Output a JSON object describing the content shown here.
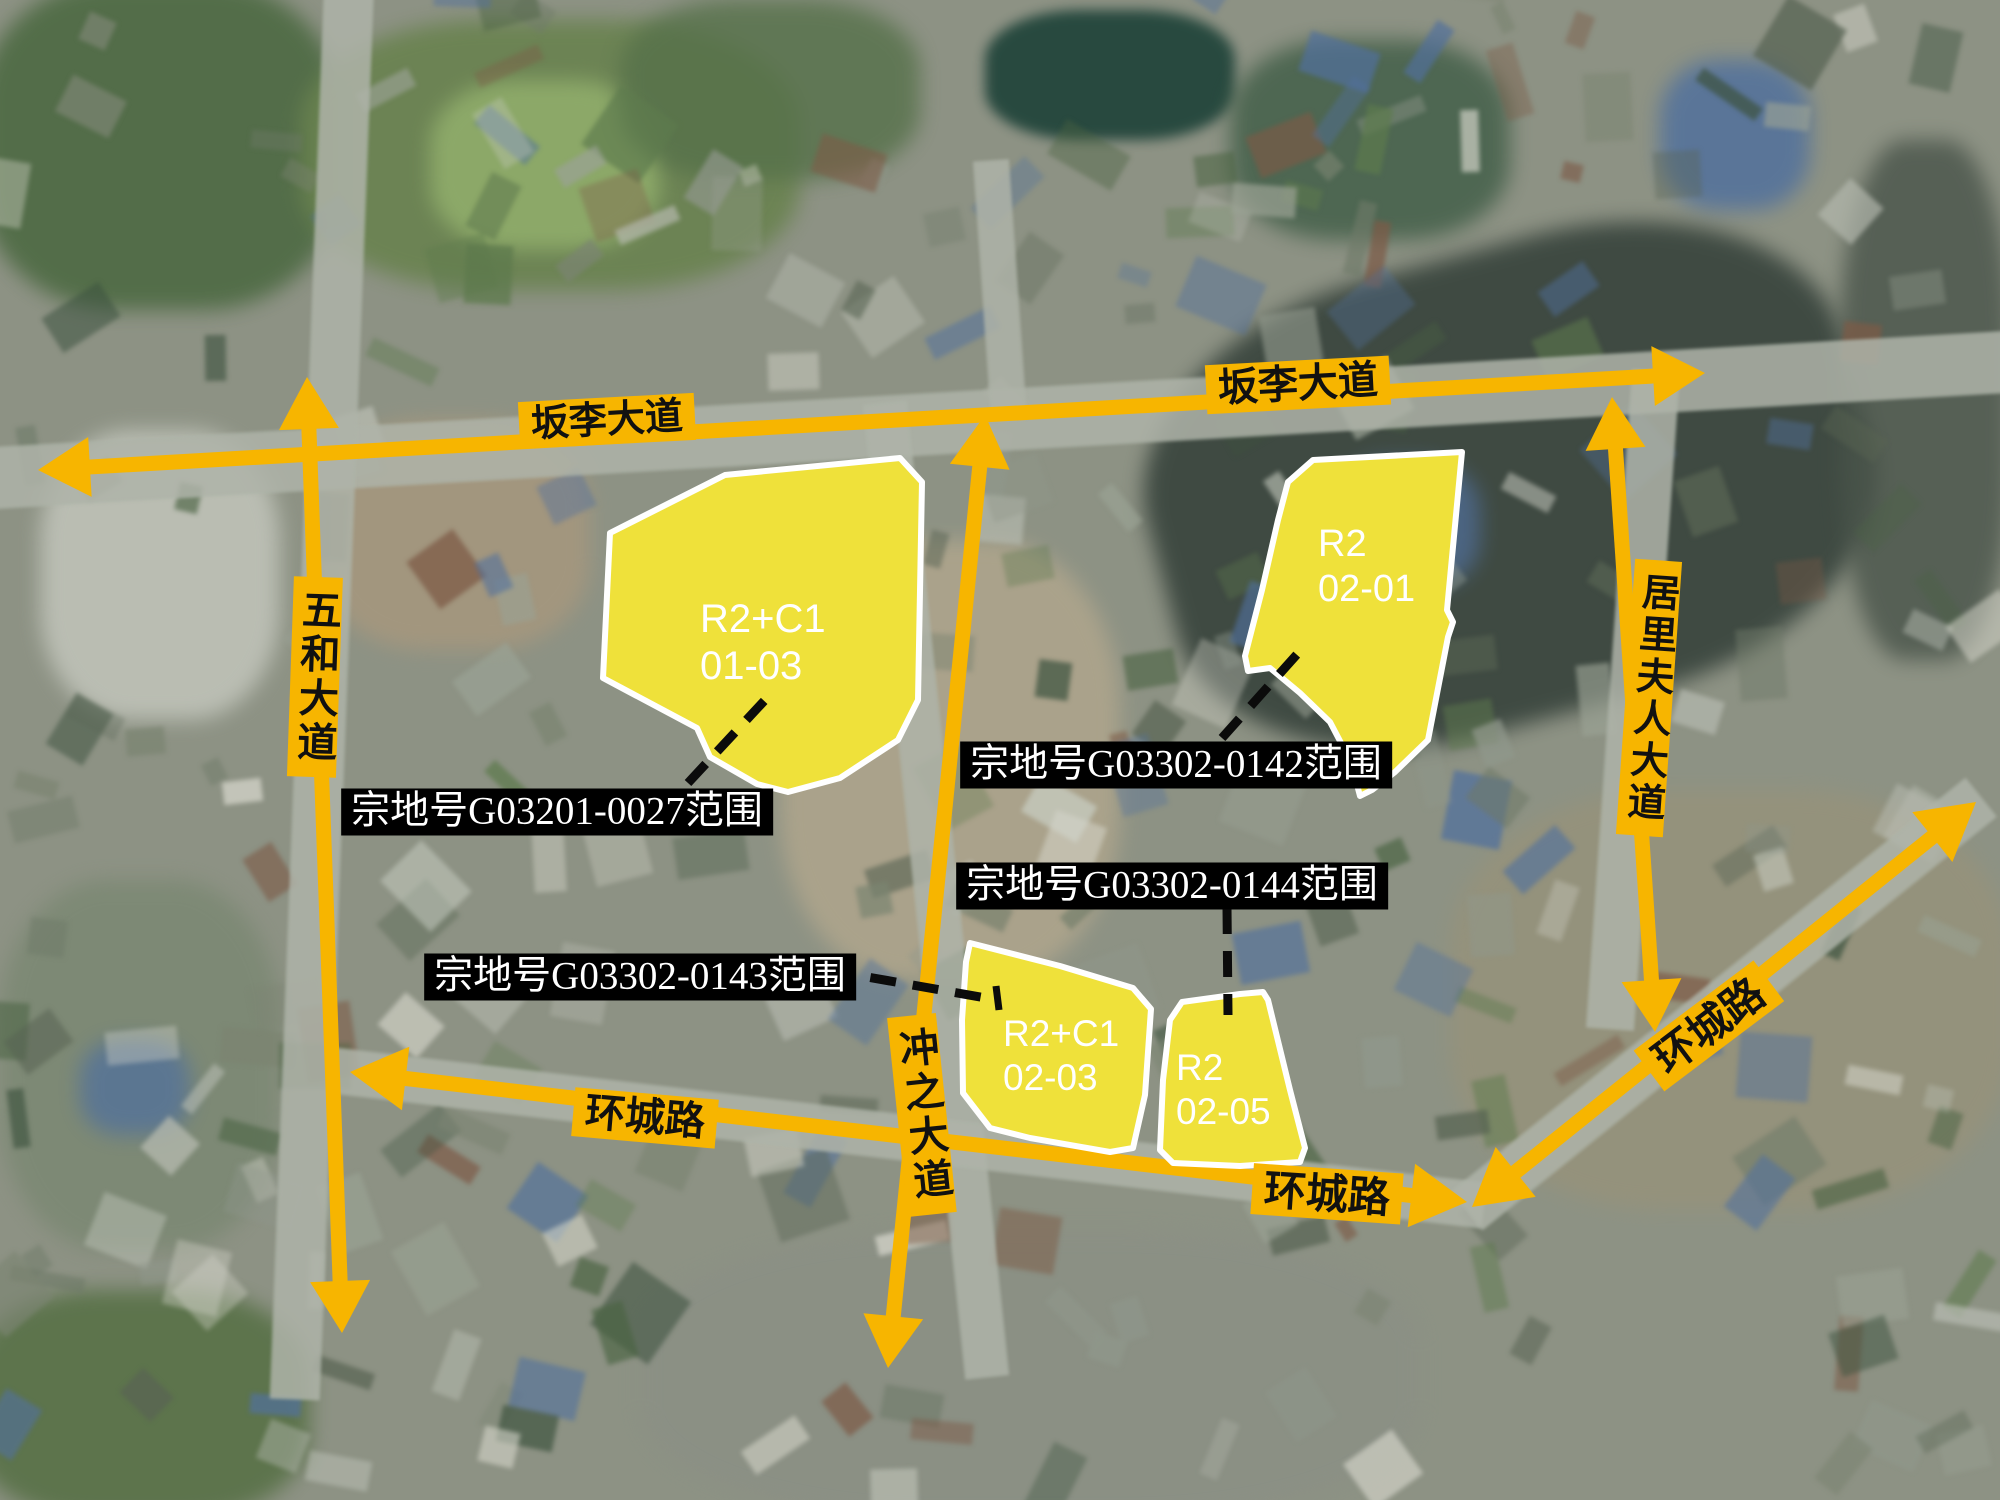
{
  "map_title": "宗地范围卫星示意图",
  "colors": {
    "road_yellow": "#F7B500",
    "parcel_yellow": "#EFE13A",
    "parcel_outline": "#FFFFFF",
    "callout_bg": "#000000",
    "callout_fg": "#FFFFFF",
    "dash_black": "#0B0B0B",
    "road_label_fg": "#111111"
  },
  "road_arrows": [
    {
      "name": "banli-avenue-arrow",
      "x1": 38,
      "y1": 470,
      "x2": 1705,
      "y2": 373,
      "w": 15,
      "head": 52,
      "hw": 30
    },
    {
      "name": "wuhe-avenue-arrow",
      "x1": 307,
      "y1": 377,
      "x2": 342,
      "y2": 1333,
      "w": 15,
      "head": 52,
      "hw": 30
    },
    {
      "name": "chongzhi-avenue-arrow",
      "x1": 985,
      "y1": 415,
      "x2": 888,
      "y2": 1368,
      "w": 15,
      "head": 52,
      "hw": 30
    },
    {
      "name": "juli-avenue-arrow",
      "x1": 1612,
      "y1": 397,
      "x2": 1655,
      "y2": 1032,
      "w": 15,
      "head": 52,
      "hw": 30
    },
    {
      "name": "huancheng-west-arrow",
      "x1": 350,
      "y1": 1072,
      "x2": 1467,
      "y2": 1202,
      "w": 15,
      "head": 56,
      "hw": 32
    },
    {
      "name": "huancheng-east-arrow",
      "x1": 1472,
      "y1": 1207,
      "x2": 1976,
      "y2": 802,
      "w": 15,
      "head": 56,
      "hw": 32
    }
  ],
  "road_labels": [
    {
      "name": "road-label-banli-west",
      "text": "坂李大道",
      "cx": 607,
      "cy": 421,
      "rot": -3,
      "vertical": false,
      "fs": 38
    },
    {
      "name": "road-label-banli-east",
      "text": "坂李大道",
      "cx": 1298,
      "cy": 385,
      "rot": -3,
      "vertical": false,
      "fs": 40
    },
    {
      "name": "road-label-wuhe",
      "text": "五和大道",
      "cx": 315,
      "cy": 677,
      "rot": 2,
      "vertical": true,
      "fs": 40
    },
    {
      "name": "road-label-juli",
      "text": "居里夫人大道",
      "cx": 1649,
      "cy": 698,
      "rot": 4,
      "vertical": true,
      "fs": 38
    },
    {
      "name": "road-label-chongzhi",
      "text": "冲之大道",
      "cx": 922,
      "cy": 1115,
      "rot": -6,
      "vertical": true,
      "fs": 40
    },
    {
      "name": "road-label-huancheng-west",
      "text": "环城路",
      "cx": 645,
      "cy": 1118,
      "rot": 5,
      "vertical": false,
      "fs": 40
    },
    {
      "name": "road-label-huancheng-south",
      "text": "环城路",
      "cx": 1327,
      "cy": 1194,
      "rot": 4,
      "vertical": false,
      "fs": 42
    },
    {
      "name": "road-label-huancheng-east",
      "text": "环城路",
      "cx": 1709,
      "cy": 1026,
      "rot": -37,
      "vertical": false,
      "fs": 42
    }
  ],
  "parcels": [
    {
      "name": "parcel-R2C1-01-03",
      "zone": "R2+C1",
      "code": "01-03",
      "tx": 700,
      "ty": 596,
      "fs": 40,
      "points": [
        [
          610,
          533
        ],
        [
          725,
          475
        ],
        [
          900,
          458
        ],
        [
          922,
          482
        ],
        [
          918,
          700
        ],
        [
          898,
          740
        ],
        [
          840,
          778
        ],
        [
          788,
          792
        ],
        [
          757,
          784
        ],
        [
          710,
          757
        ],
        [
          697,
          728
        ],
        [
          603,
          678
        ]
      ]
    },
    {
      "name": "parcel-R2-02-01",
      "zone": "R2",
      "code": "02-01",
      "tx": 1318,
      "ty": 522,
      "fs": 38,
      "points": [
        [
          1288,
          482
        ],
        [
          1313,
          460
        ],
        [
          1462,
          452
        ],
        [
          1447,
          610
        ],
        [
          1453,
          622
        ],
        [
          1448,
          637
        ],
        [
          1428,
          740
        ],
        [
          1395,
          772
        ],
        [
          1372,
          790
        ],
        [
          1360,
          796
        ],
        [
          1351,
          762
        ],
        [
          1330,
          722
        ],
        [
          1300,
          693
        ],
        [
          1270,
          668
        ],
        [
          1248,
          671
        ],
        [
          1245,
          656
        ],
        [
          1262,
          590
        ],
        [
          1278,
          520
        ]
      ]
    },
    {
      "name": "parcel-R2C1-02-03",
      "zone": "R2+C1",
      "code": "02-03",
      "tx": 1003,
      "ty": 1012,
      "fs": 37,
      "points": [
        [
          970,
          943
        ],
        [
          1060,
          966
        ],
        [
          1133,
          988
        ],
        [
          1151,
          1009
        ],
        [
          1145,
          1095
        ],
        [
          1133,
          1148
        ],
        [
          1110,
          1152
        ],
        [
          1030,
          1138
        ],
        [
          990,
          1128
        ],
        [
          963,
          1093
        ],
        [
          962,
          1020
        ],
        [
          966,
          962
        ]
      ]
    },
    {
      "name": "parcel-R2-02-05",
      "zone": "R2",
      "code": "02-05",
      "tx": 1176,
      "ty": 1046,
      "fs": 37,
      "points": [
        [
          1182,
          1002
        ],
        [
          1240,
          994
        ],
        [
          1263,
          992
        ],
        [
          1268,
          1000
        ],
        [
          1290,
          1090
        ],
        [
          1305,
          1148
        ],
        [
          1300,
          1162
        ],
        [
          1240,
          1166
        ],
        [
          1173,
          1163
        ],
        [
          1160,
          1150
        ],
        [
          1163,
          1080
        ],
        [
          1170,
          1020
        ]
      ]
    }
  ],
  "callouts": [
    {
      "name": "callout-G03201-0027",
      "text": "宗地号G03201-0027范围",
      "cx": 557,
      "cy": 812,
      "line": [
        688,
        783,
        765,
        700
      ]
    },
    {
      "name": "callout-G03302-0142",
      "text": "宗地号G03302-0142范围",
      "cx": 1176,
      "cy": 765,
      "line": [
        1222,
        738,
        1308,
        642
      ]
    },
    {
      "name": "callout-G03302-0144",
      "text": "宗地号G03302-0144范围",
      "cx": 1172,
      "cy": 886,
      "line": [
        1227,
        908,
        1228,
        1015
      ]
    },
    {
      "name": "callout-G03302-0143",
      "text": "宗地号G03302-0143范围",
      "cx": 640,
      "cy": 977,
      "line": [
        828,
        970,
        997,
        1000
      ],
      "tick": [
        996,
        986,
        999,
        1010
      ]
    }
  ]
}
